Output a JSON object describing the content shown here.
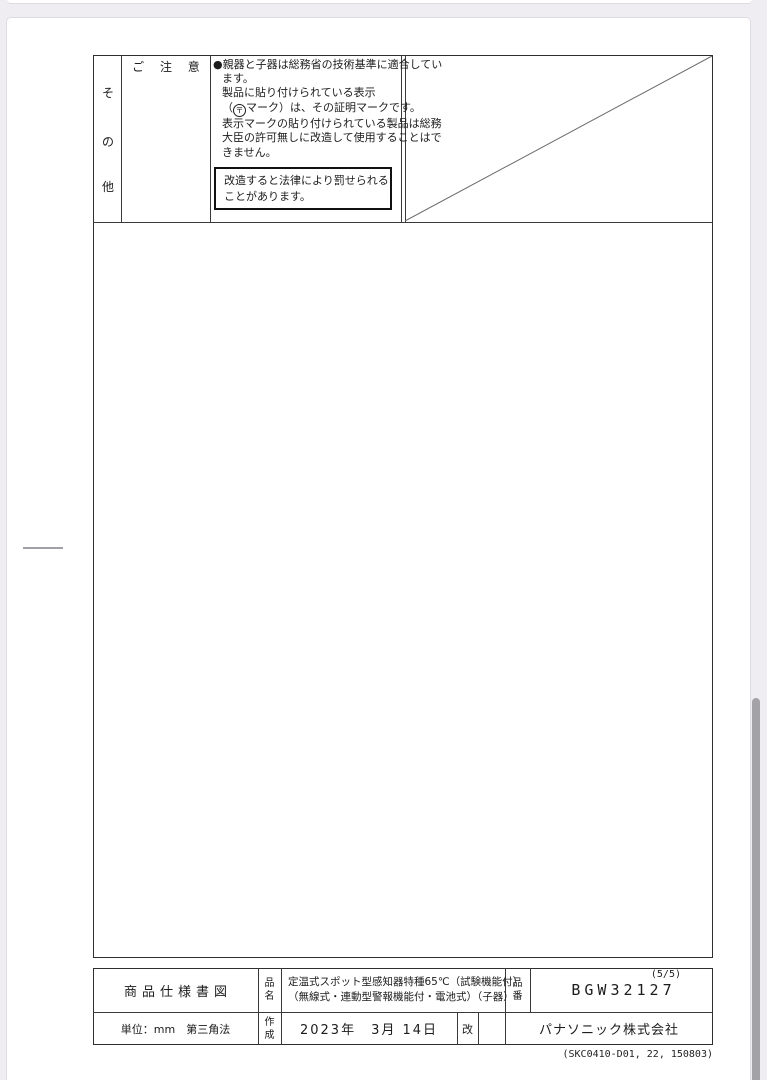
{
  "notice_section": {
    "side_label_chars": [
      "そ",
      "の",
      "他"
    ],
    "header": "ご 注 意",
    "lines": [
      "●親器と子器は総務省の技術基準に適合してい",
      "ます。",
      "製品に貼り付けられている表示",
      "表示マークの貼り付けられている製品は総務",
      "大臣の許可無しに改造して使用することはで",
      "きません。"
    ],
    "mark_line": {
      "prefix": "（",
      "mark": "〒",
      "suffix": "マーク）は、その証明マークです。"
    },
    "warning_lines": [
      "改造すると法律により罰せられる",
      "ことがあります。"
    ]
  },
  "title_block": {
    "doc_type": "商品仕様書図",
    "name_label_chars": [
      "品",
      "名"
    ],
    "product_name_line1": "定温式スポット型感知器特種65℃（試験機能付）",
    "product_name_line2": "（無線式・連動型警報機能付・電池式）（子器）",
    "number_label_chars": [
      "品",
      "番"
    ],
    "page_indicator": "(5/5)",
    "product_number": "BGW32127",
    "units_note": "単位：mm　第三角法",
    "created_label_chars": [
      "作",
      "成"
    ],
    "created_date": "2023年　3月 14日",
    "revision_label": "改",
    "company": "パナソニック株式会社"
  },
  "footer": {
    "doc_code": "(SKC0410-D01, 22, 150803)"
  }
}
